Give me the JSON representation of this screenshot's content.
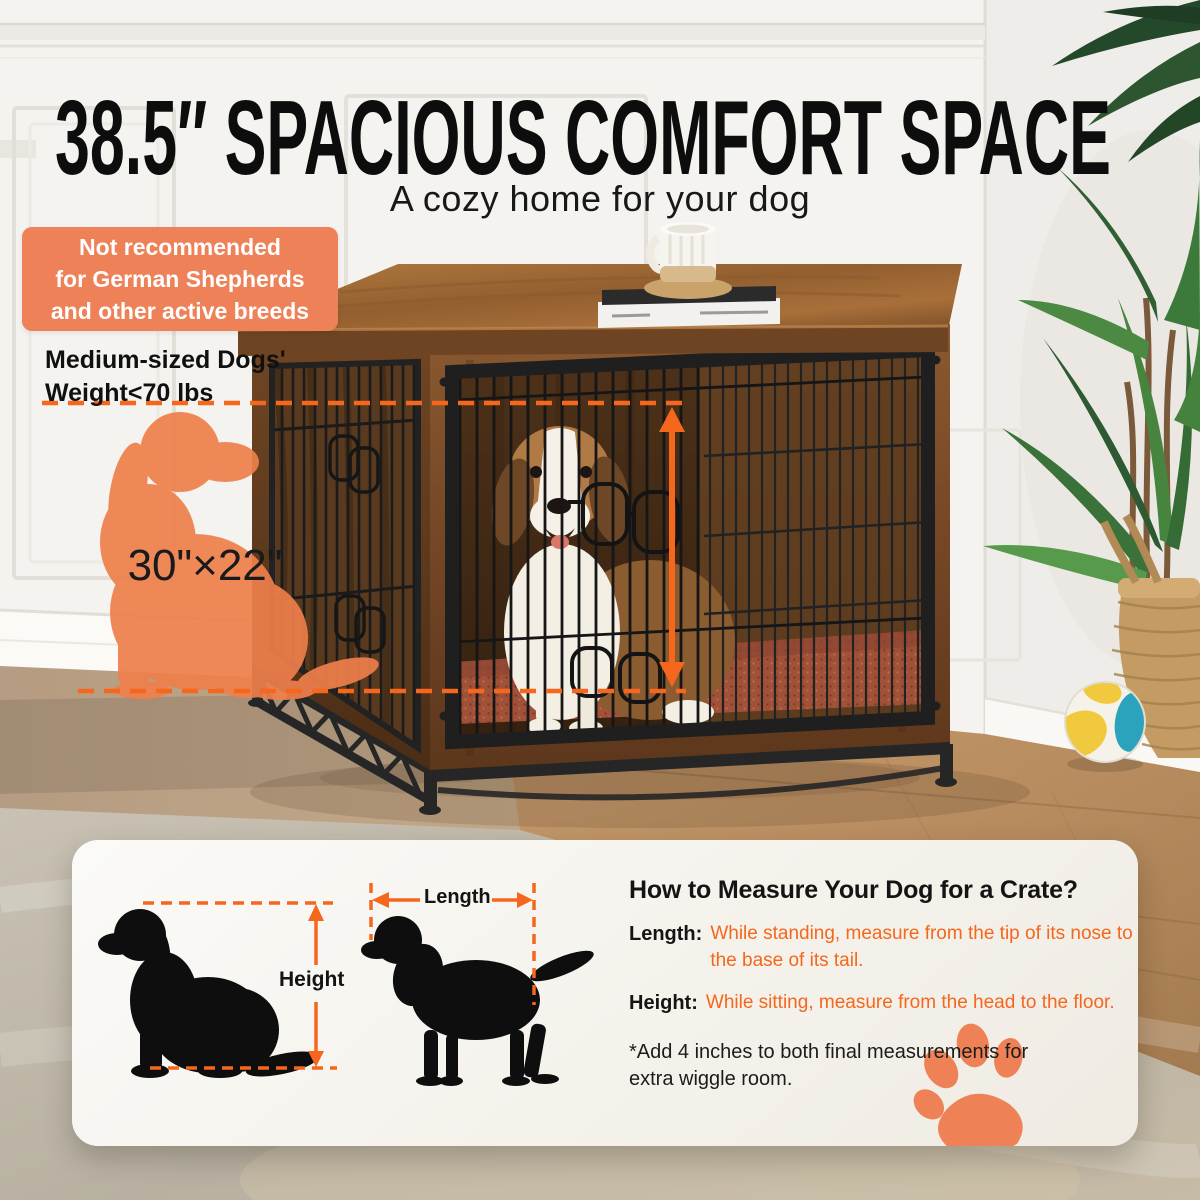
{
  "header": {
    "title": "38.5″ SPACIOUS COMFORT SPACE",
    "subtitle": "A cozy home for your dog"
  },
  "badge": {
    "line1": "Not recommended",
    "line2": "for German Shepherds",
    "line3": "and other active breeds"
  },
  "weight_note": {
    "line1": "Medium-sized Dogs'",
    "line2": "Weight<70 lbs"
  },
  "crate_silhouette": {
    "size_label": "30\"×22\""
  },
  "measure_panel": {
    "heading": "How to Measure Your Dog for a Crate?",
    "length": {
      "label": "Length:",
      "text": "While standing, measure from the tip of its nose to the base of its tail."
    },
    "height": {
      "label": "Height:",
      "text": "While sitting, measure from the head to the floor."
    },
    "footnote": "*Add 4 inches to both final measurements for extra wiggle room.",
    "diagram": {
      "height_label": "Height",
      "length_label": "Length"
    }
  },
  "colors": {
    "accent_orange": "#f4671d",
    "badge_orange": "#ef8158",
    "silhouette_orange": "#ef7f4b",
    "panel_bg": "#f7f5f0",
    "title_black": "#0d0d0d"
  },
  "icons": {
    "paw": "paw-print-icon",
    "height_arrow": "vertical-double-arrow-icon",
    "length_arrow": "horizontal-double-arrow-icon",
    "crate_height_arrow": "vertical-double-arrow-icon"
  }
}
